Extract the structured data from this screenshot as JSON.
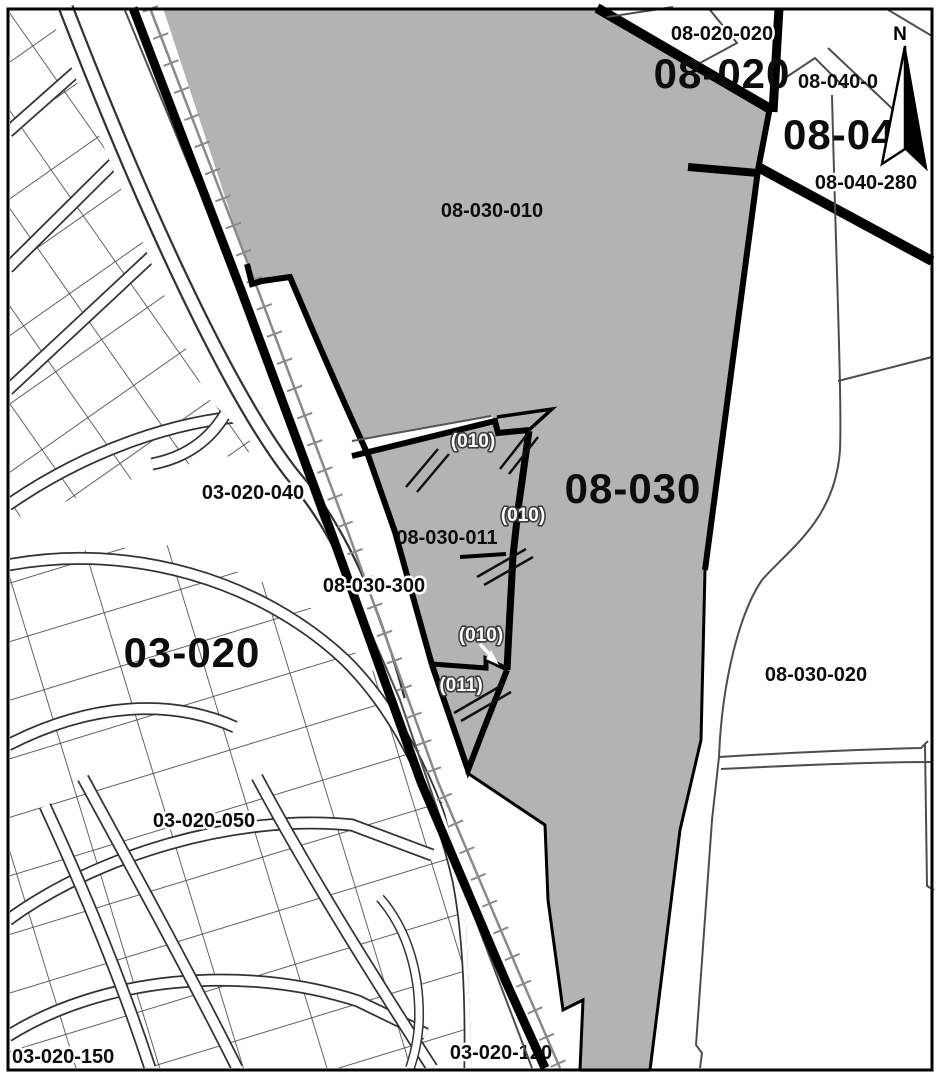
{
  "map": {
    "type": "cadastral-parcel-map",
    "north_label": "N",
    "colors": {
      "zone_fill_gray": "#b3b3b3",
      "boundary_black": "#000000",
      "rail_gray": "#8a8a8a",
      "parcel_line": "#4a4a4a",
      "background": "#ffffff"
    },
    "labels": {
      "zone_03_020": "03-020",
      "parcel_03_020_040": "03-020-040",
      "parcel_03_020_050": "03-020-050",
      "parcel_03_020_150": "03-020-150",
      "parcel_03_020_120": "03-020-120",
      "zone_08_030": "08-030",
      "parcel_08_030_010": "08-030-010",
      "parcel_08_030_011": "08-030-011",
      "parcel_08_030_300": "08-030-300",
      "parcel_08_030_020": "08-030-020",
      "zone_08_020": "08-020",
      "parcel_08_020_020": "08-020-020",
      "zone_08_04": "08-04",
      "parcel_08_040_0": "08-040-0",
      "parcel_08_040_280": "08-040-280",
      "marker_010": "(010)",
      "marker_011": "(011)"
    }
  }
}
